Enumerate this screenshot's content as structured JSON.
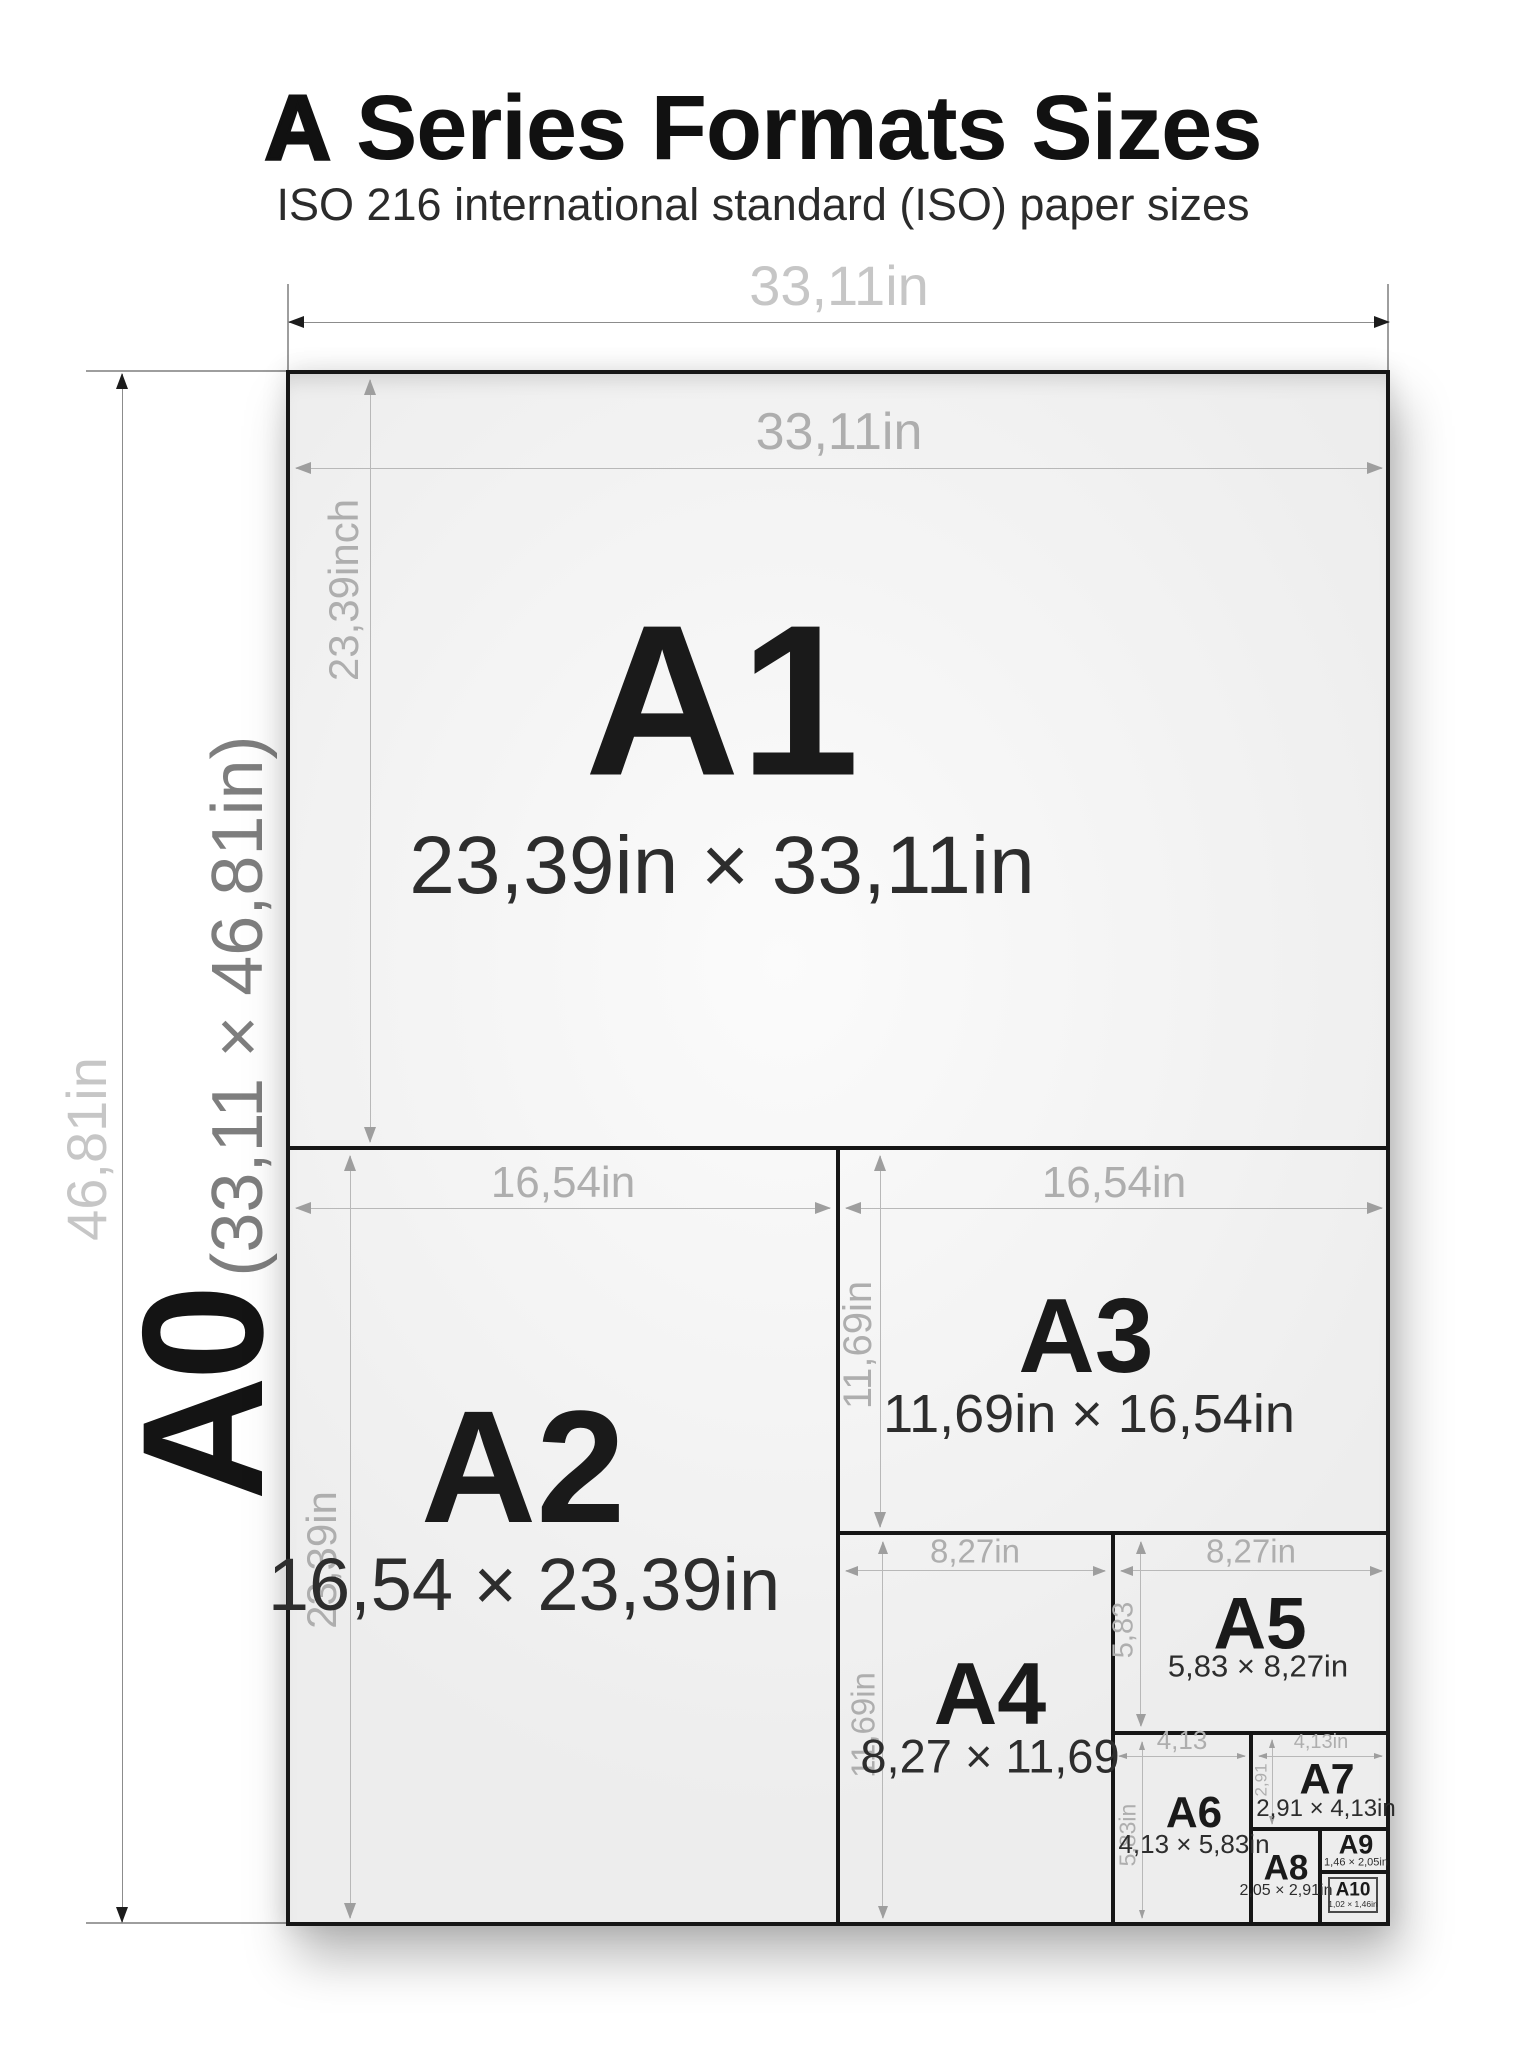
{
  "title": {
    "lead": "A",
    "rest": "Series Formats Sizes"
  },
  "subtitle": "ISO 216 international standard (ISO) paper sizes",
  "outer_dims": {
    "width": "33,11in",
    "height": "46,81in"
  },
  "a0": {
    "label": "A0",
    "dims": "(33,11 × 46,81in)"
  },
  "papers": [
    {
      "name": "A1",
      "size": "23,39in × 33,11in",
      "width_dim": "33,11in",
      "height_dim": "23,39inch"
    },
    {
      "name": "A2",
      "size": "16,54 × 23,39in",
      "width_dim": "16,54in",
      "height_dim": "23,39in"
    },
    {
      "name": "A3",
      "size": "11,69in × 16,54in",
      "width_dim": "16,54in",
      "height_dim": "11,69in"
    },
    {
      "name": "A4",
      "size": "8,27 × 11,69",
      "width_dim": "8,27in",
      "height_dim": "11,69in"
    },
    {
      "name": "A5",
      "size": "5,83 × 8,27in",
      "width_dim": "8,27in",
      "height_dim": "5,83"
    },
    {
      "name": "A6",
      "size": "4,13 × 5,83in",
      "width_dim": "4,13",
      "height_dim": "5,83in"
    },
    {
      "name": "A7",
      "size": "2,91 × 4,13in",
      "width_dim": "4,13in",
      "height_dim": "2,91"
    },
    {
      "name": "A8",
      "size": "2,05 × 2,91in"
    },
    {
      "name": "A9",
      "size": "1,46 × 2,05in"
    },
    {
      "name": "A10",
      "size": "1,02 × 1,46in"
    }
  ],
  "colors": {
    "border": "#161616",
    "paper_fill": "#f2f2f2",
    "inner_dim_line": "#b8b8b8",
    "inner_dim_text": "#aeaeae",
    "outer_dim_text": "#c6c6c6",
    "label_text": "#1a1a1a"
  }
}
